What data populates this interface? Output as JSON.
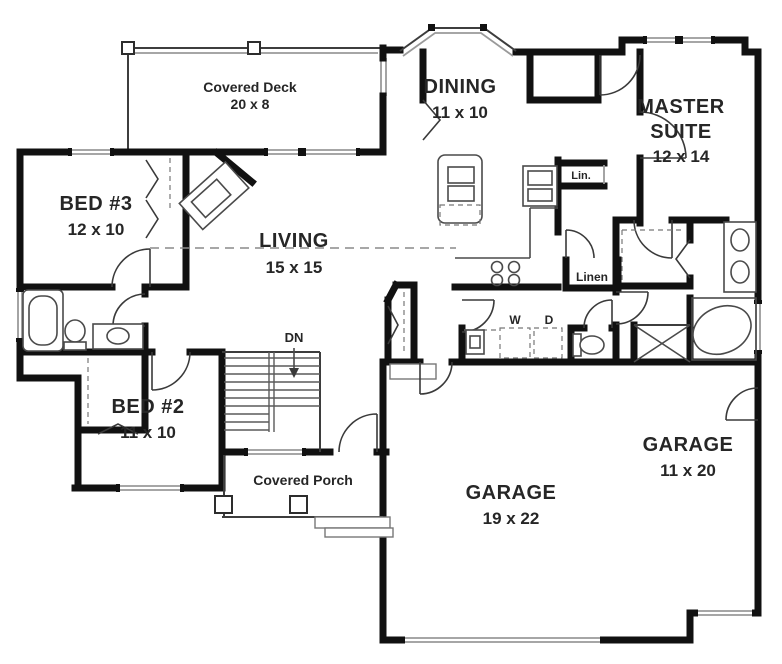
{
  "plan_title": "House Floor Plan",
  "rooms": {
    "covered_deck": {
      "name": "Covered Deck",
      "dims": "20 x 8"
    },
    "dining": {
      "name": "DINING",
      "dims": "11 x 10"
    },
    "master_suite": {
      "line1": "MASTER",
      "line2": "SUITE",
      "dims": "12 x 14"
    },
    "bed3": {
      "name": "BED #3",
      "dims": "12 x 10"
    },
    "living": {
      "name": "LIVING",
      "dims": "15 x 15"
    },
    "bed2": {
      "name": "BED #2",
      "dims": "11 x 10"
    },
    "covered_porch": {
      "name": "Covered Porch"
    },
    "garage_main": {
      "name": "GARAGE",
      "dims": "19 x 22"
    },
    "garage_side": {
      "name": "GARAGE",
      "dims": "11 x 20"
    }
  },
  "closets": {
    "lin": {
      "name": "Lin."
    },
    "linen": {
      "name": "Linen"
    }
  },
  "laundry": {
    "washer": {
      "name": "W"
    },
    "dryer": {
      "name": "D"
    }
  },
  "stairs": {
    "direction_label": "DN"
  },
  "colors": {
    "wall_color": "#111111",
    "window_color": "#9a9a9a",
    "fixture_line_color": "#4a4a4a",
    "label_color": "#262626",
    "background": "#ffffff"
  }
}
